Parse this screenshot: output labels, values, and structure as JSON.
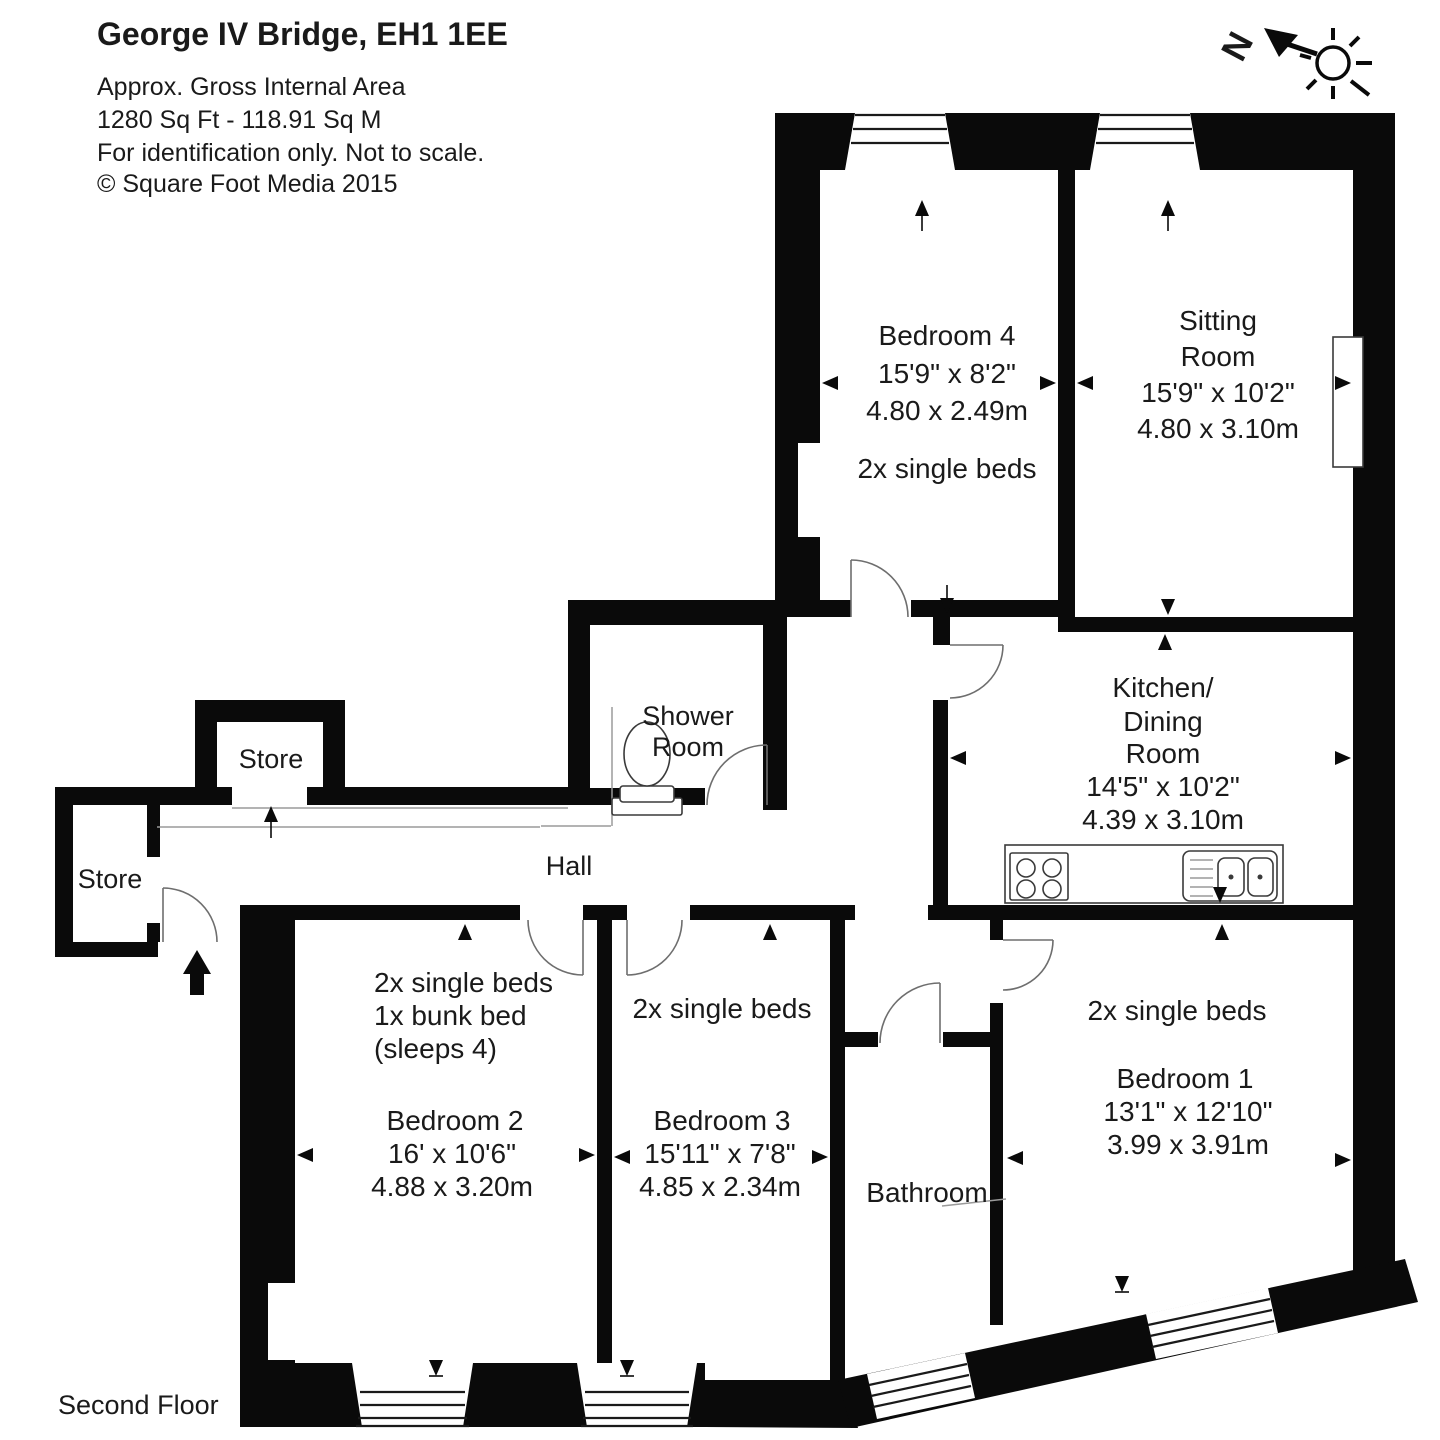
{
  "header": {
    "title": "George IV Bridge, EH1 1EE",
    "line1": "Approx. Gross Internal Area",
    "line2": "1280 Sq Ft  -  118.91 Sq M",
    "line3": "For identification only. Not to scale.",
    "line4": "© Square Foot Media 2015"
  },
  "compass": {
    "north_label": "N"
  },
  "floor_label": "Second Floor",
  "rooms": {
    "bedroom4": {
      "name": "Bedroom 4",
      "imperial": "15'9\" x 8'2\"",
      "metric": "4.80 x 2.49m",
      "beds": "2x single beds"
    },
    "sitting_room": {
      "name_line1": "Sitting",
      "name_line2": "Room",
      "imperial": "15'9\" x 10'2\"",
      "metric": "4.80 x 3.10m"
    },
    "kitchen": {
      "name_line1": "Kitchen/",
      "name_line2": "Dining",
      "name_line3": "Room",
      "imperial": "14'5\" x 10'2\"",
      "metric": "4.39 x 3.10m"
    },
    "bedroom1": {
      "name": "Bedroom 1",
      "imperial": "13'1\" x 12'10\"",
      "metric": "3.99 x 3.91m",
      "beds": "2x single beds"
    },
    "bedroom2": {
      "name": "Bedroom 2",
      "imperial": "16' x 10'6\"",
      "metric": "4.88 x 3.20m",
      "beds_line1": "2x single beds",
      "beds_line2": "1x bunk bed",
      "beds_line3": "(sleeps 4)"
    },
    "bedroom3": {
      "name": "Bedroom 3",
      "imperial": "15'11\" x 7'8\"",
      "metric": "4.85 x 2.34m",
      "beds": "2x single beds"
    },
    "bathroom": {
      "name": "Bathroom"
    },
    "shower_room": {
      "name_line1": "Shower",
      "name_line2": "Room"
    },
    "hall": {
      "name": "Hall"
    },
    "store_top": {
      "name": "Store"
    },
    "store_left": {
      "name": "Store"
    }
  }
}
